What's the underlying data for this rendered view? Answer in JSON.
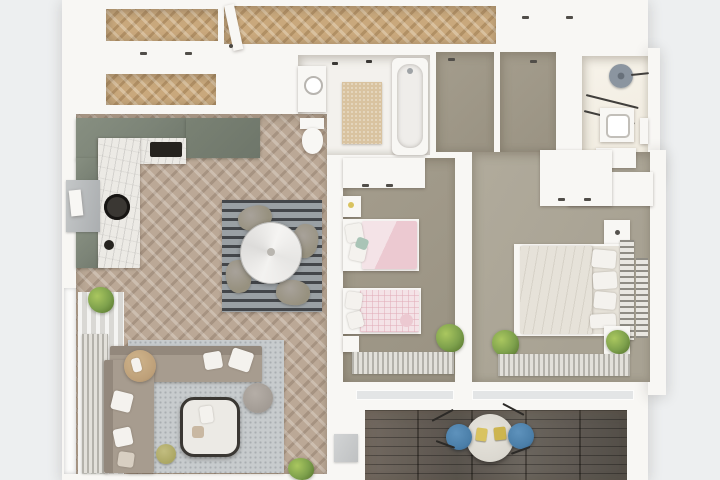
{
  "meta": {
    "kind": "photorealistic top-down 3D floor plan render of a two-bedroom apartment",
    "visible_text": "none"
  },
  "colors": {
    "bg": "#edeff0",
    "wall": "#f8f7f4",
    "hallWood": "#c9a87c",
    "livingWood": "#bba896",
    "taupeKids": "#a49d8d",
    "taupeMaster": "#a8a293",
    "tile": "#f3f1ed",
    "tileCream": "#efeade",
    "sage": "#7c8477",
    "sageDark": "#6e766a",
    "marble": "#eceae5",
    "dark": "#26231f",
    "matBeige": "#d9c3a0",
    "rugLight": "#c7cbcd",
    "rugDot": "#a9aeb1",
    "rugDarkA": "#43464a",
    "rugDarkB": "#9aa0a4",
    "stripeA": "#b4b2ab",
    "stripeB": "#e2e0da",
    "curtainA": "#f4f4f2",
    "curtainB": "#d9d8d4",
    "sofa": "#a79c8f",
    "sofaDark": "#93887c",
    "pillow": "#f4f2ee",
    "chairGrey": "#97917f",
    "woodSide": "#bd9f78",
    "pink": "#ecc9d1",
    "pinkPale": "#f4e3e7",
    "bedWhite": "#efece6",
    "mattress": "#e6e2d9",
    "green": "#7da04c",
    "greenDark": "#59772f",
    "blue": "#4a7ea8",
    "yellow": "#d9c35f",
    "showerGrey": "#8b95a0",
    "sill": "#abaeb0",
    "plank": "#5a534b",
    "balconyTable": "#dbd8d0"
  },
  "rooms": {
    "entry": {
      "label": "Entry hallway",
      "floor": "honey herringbone parquet",
      "items": [
        "open entrance door",
        "built-in closets"
      ]
    },
    "closets": {
      "label": "Hall closets",
      "items": [
        "two herringbone-floored wardrobe niches"
      ]
    },
    "kitchen": {
      "label": "Kitchen",
      "items": [
        "sage green L-shaped cabinets",
        "marble countertop",
        "black cooktop",
        "round black sink with faucet",
        "window with grey sill",
        "framed art"
      ]
    },
    "living": {
      "label": "Living and dining room",
      "items": [
        "grey herringbone parquet",
        "dark striped dining rug",
        "round marble dining table",
        "four grey chairs",
        "L-shaped taupe sofa with white pillows",
        "square marble coffee table",
        "round pouf",
        "small olive pouf",
        "round wooden side table with books",
        "curtained window with radiator",
        "two green plants"
      ]
    },
    "bath1": {
      "label": "Family bathroom",
      "items": [
        "bathtub",
        "toilet",
        "washbasin unit",
        "beige bath mat",
        "towel hooks"
      ]
    },
    "corridor": {
      "label": "Inner corridor niches",
      "items": [
        "taupe floor",
        "closet fronts"
      ]
    },
    "bath2": {
      "label": "Shower room",
      "items": [
        "round rain shower",
        "two towel rails",
        "vanity basin",
        "storage cabinet"
      ]
    },
    "kids": {
      "label": "Kids bedroom",
      "items": [
        "two single beds with pink bedding",
        "white wardrobe",
        "two nightstands",
        "green plant",
        "striped rug under window"
      ]
    },
    "master": {
      "label": "Master bedroom",
      "items": [
        "double bed with white bedding",
        "slatted headboard",
        "white wardrobe",
        "two nightstands",
        "two green plants",
        "striped rug under window",
        "wall ladder rack"
      ]
    },
    "balcony": {
      "label": "Balcony",
      "items": [
        "dark wood plank decking",
        "round bistro table with yellow seat cushions",
        "two blue chairs"
      ]
    }
  }
}
